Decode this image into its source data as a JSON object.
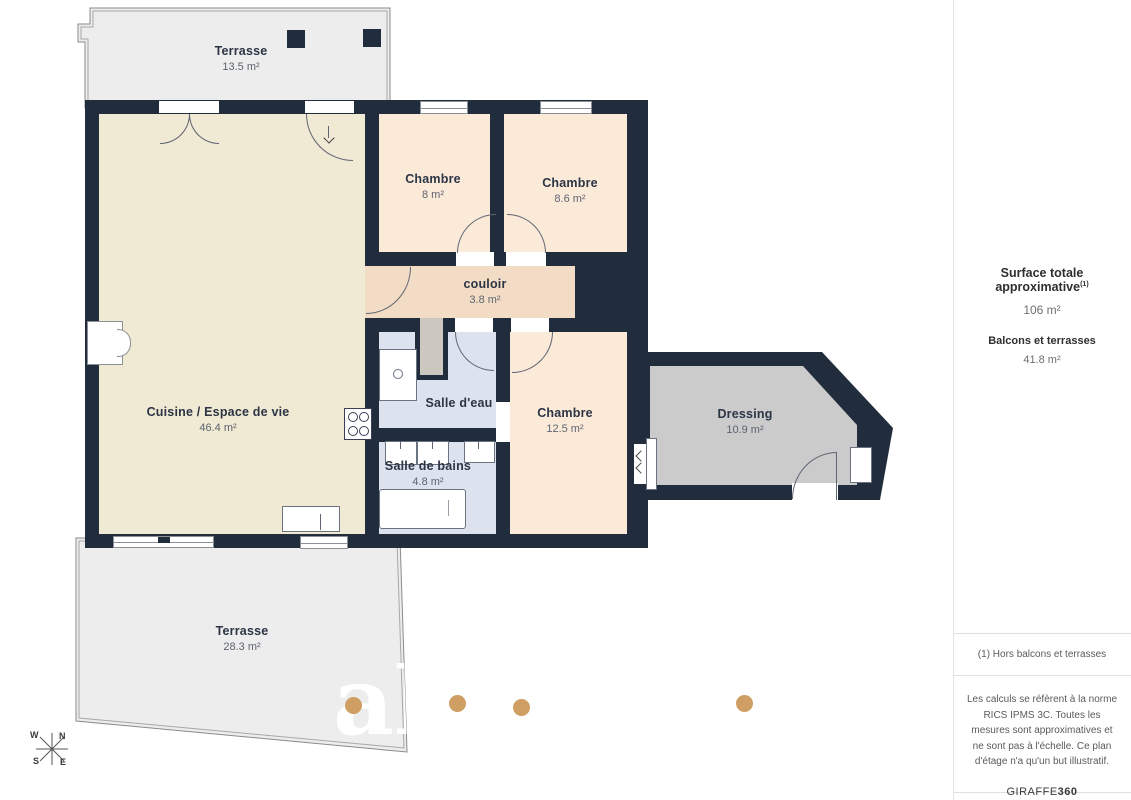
{
  "palette": {
    "wall": "#212d3d",
    "living": "#f0e9d3",
    "bedroom": "#fcead9",
    "hallway": "#f3dcc6",
    "bathroom": "#dde3ee",
    "dressing": "#cbcbcb",
    "terrace": "#ededed",
    "photo_dot": "#cf9e63"
  },
  "rooms": {
    "terrace_top": {
      "name": "Terrasse",
      "area": "13.5 m²"
    },
    "terrace_bottom": {
      "name": "Terrasse",
      "area": "28.3 m²"
    },
    "living": {
      "name": "Cuisine / Espace de vie",
      "area": "46.4 m²"
    },
    "bedroom1": {
      "name": "Chambre",
      "area": "8 m²"
    },
    "bedroom2": {
      "name": "Chambre",
      "area": "8.6 m²"
    },
    "hallway": {
      "name": "couloir",
      "area": "3.8 m²"
    },
    "shower_room": {
      "name": "Salle d'eau",
      "area": ""
    },
    "bathroom": {
      "name": "Salle de bains",
      "area": "4.8 m²"
    },
    "bedroom3": {
      "name": "Chambre",
      "area": "12.5 m²"
    },
    "dressing": {
      "name": "Dressing",
      "area": "10.9 m²"
    }
  },
  "compass": {
    "n": "N",
    "s": "S",
    "e": "E",
    "w": "W"
  },
  "watermark": {
    "text": "ah"
  },
  "sidebar": {
    "title": "Surface totale approximative",
    "title_sup": "(1)",
    "total_value": "106 m²",
    "balcony_label": "Balcons et terrasses",
    "balcony_value": "41.8 m²",
    "footnote": "(1) Hors balcons et terrasses",
    "disclaimer": "Les calculs se réfèrent à la norme RICS IPMS 3C. Toutes les mesures sont approximatives et ne sont pas à l'échelle. Ce plan d'étage n'a qu'un but illustratif.",
    "brand_regular": "GIRAFFE",
    "brand_bold": "360"
  }
}
